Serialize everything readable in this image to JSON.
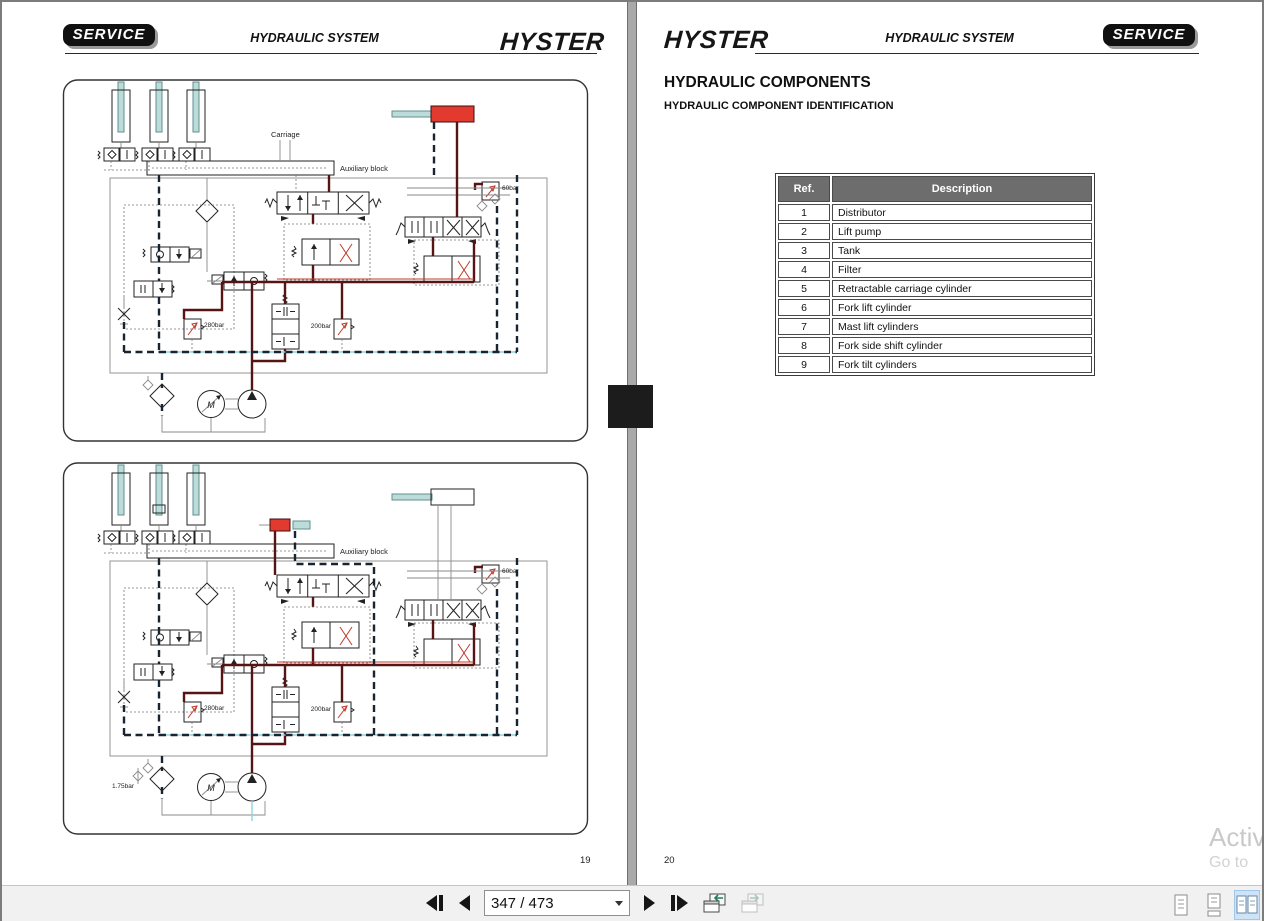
{
  "window": {
    "watermark_line1": "Activ",
    "watermark_line2": "Go to"
  },
  "left_page": {
    "header": {
      "badge": "SERVICE",
      "title": "HYDRAULIC SYSTEM",
      "logo": "HYSTER"
    },
    "page_number": "19"
  },
  "right_page": {
    "header": {
      "logo": "HYSTER",
      "title": "HYDRAULIC SYSTEM",
      "badge": "SERVICE"
    },
    "heading": "HYDRAULIC COMPONENTS",
    "subheading": "HYDRAULIC COMPONENT IDENTIFICATION",
    "table": {
      "columns": [
        "Ref.",
        "Description"
      ],
      "rows": [
        [
          "1",
          "Distributor"
        ],
        [
          "2",
          "Lift pump"
        ],
        [
          "3",
          "Tank"
        ],
        [
          "4",
          "Filter"
        ],
        [
          "5",
          "Retractable carriage cylinder"
        ],
        [
          "6",
          "Fork lift cylinder"
        ],
        [
          "7",
          "Mast lift cylinders"
        ],
        [
          "8",
          "Fork side shift cylinder"
        ],
        [
          "9",
          "Fork tilt cylinders"
        ]
      ]
    },
    "page_number": "20"
  },
  "diagram_labels": {
    "carriage": "Carriage",
    "auxiliary_block": "Auxiliary block",
    "bar60": "60bar",
    "bar280": "280bar",
    "bar200": "200bar",
    "bar175": "1.75bar",
    "motor": "M"
  },
  "toolbar": {
    "page_indicator": "347 / 473",
    "nav_icons": [
      "first-page",
      "previous-page",
      "next-page",
      "last-page"
    ],
    "history_icons": [
      "previous-view",
      "next-view"
    ],
    "view_mode_icons": [
      "single-page",
      "continuous",
      "two-page",
      "two-page-continuous"
    ],
    "selected_view_mode": "two-page"
  },
  "colors": {
    "accent_red": "#e23a2e",
    "cylinder_rod": "#bcdcda",
    "pressure_line": "#571414",
    "table_header_bg": "#6d6d6d",
    "view_selected_bg": "#cde3f7"
  }
}
